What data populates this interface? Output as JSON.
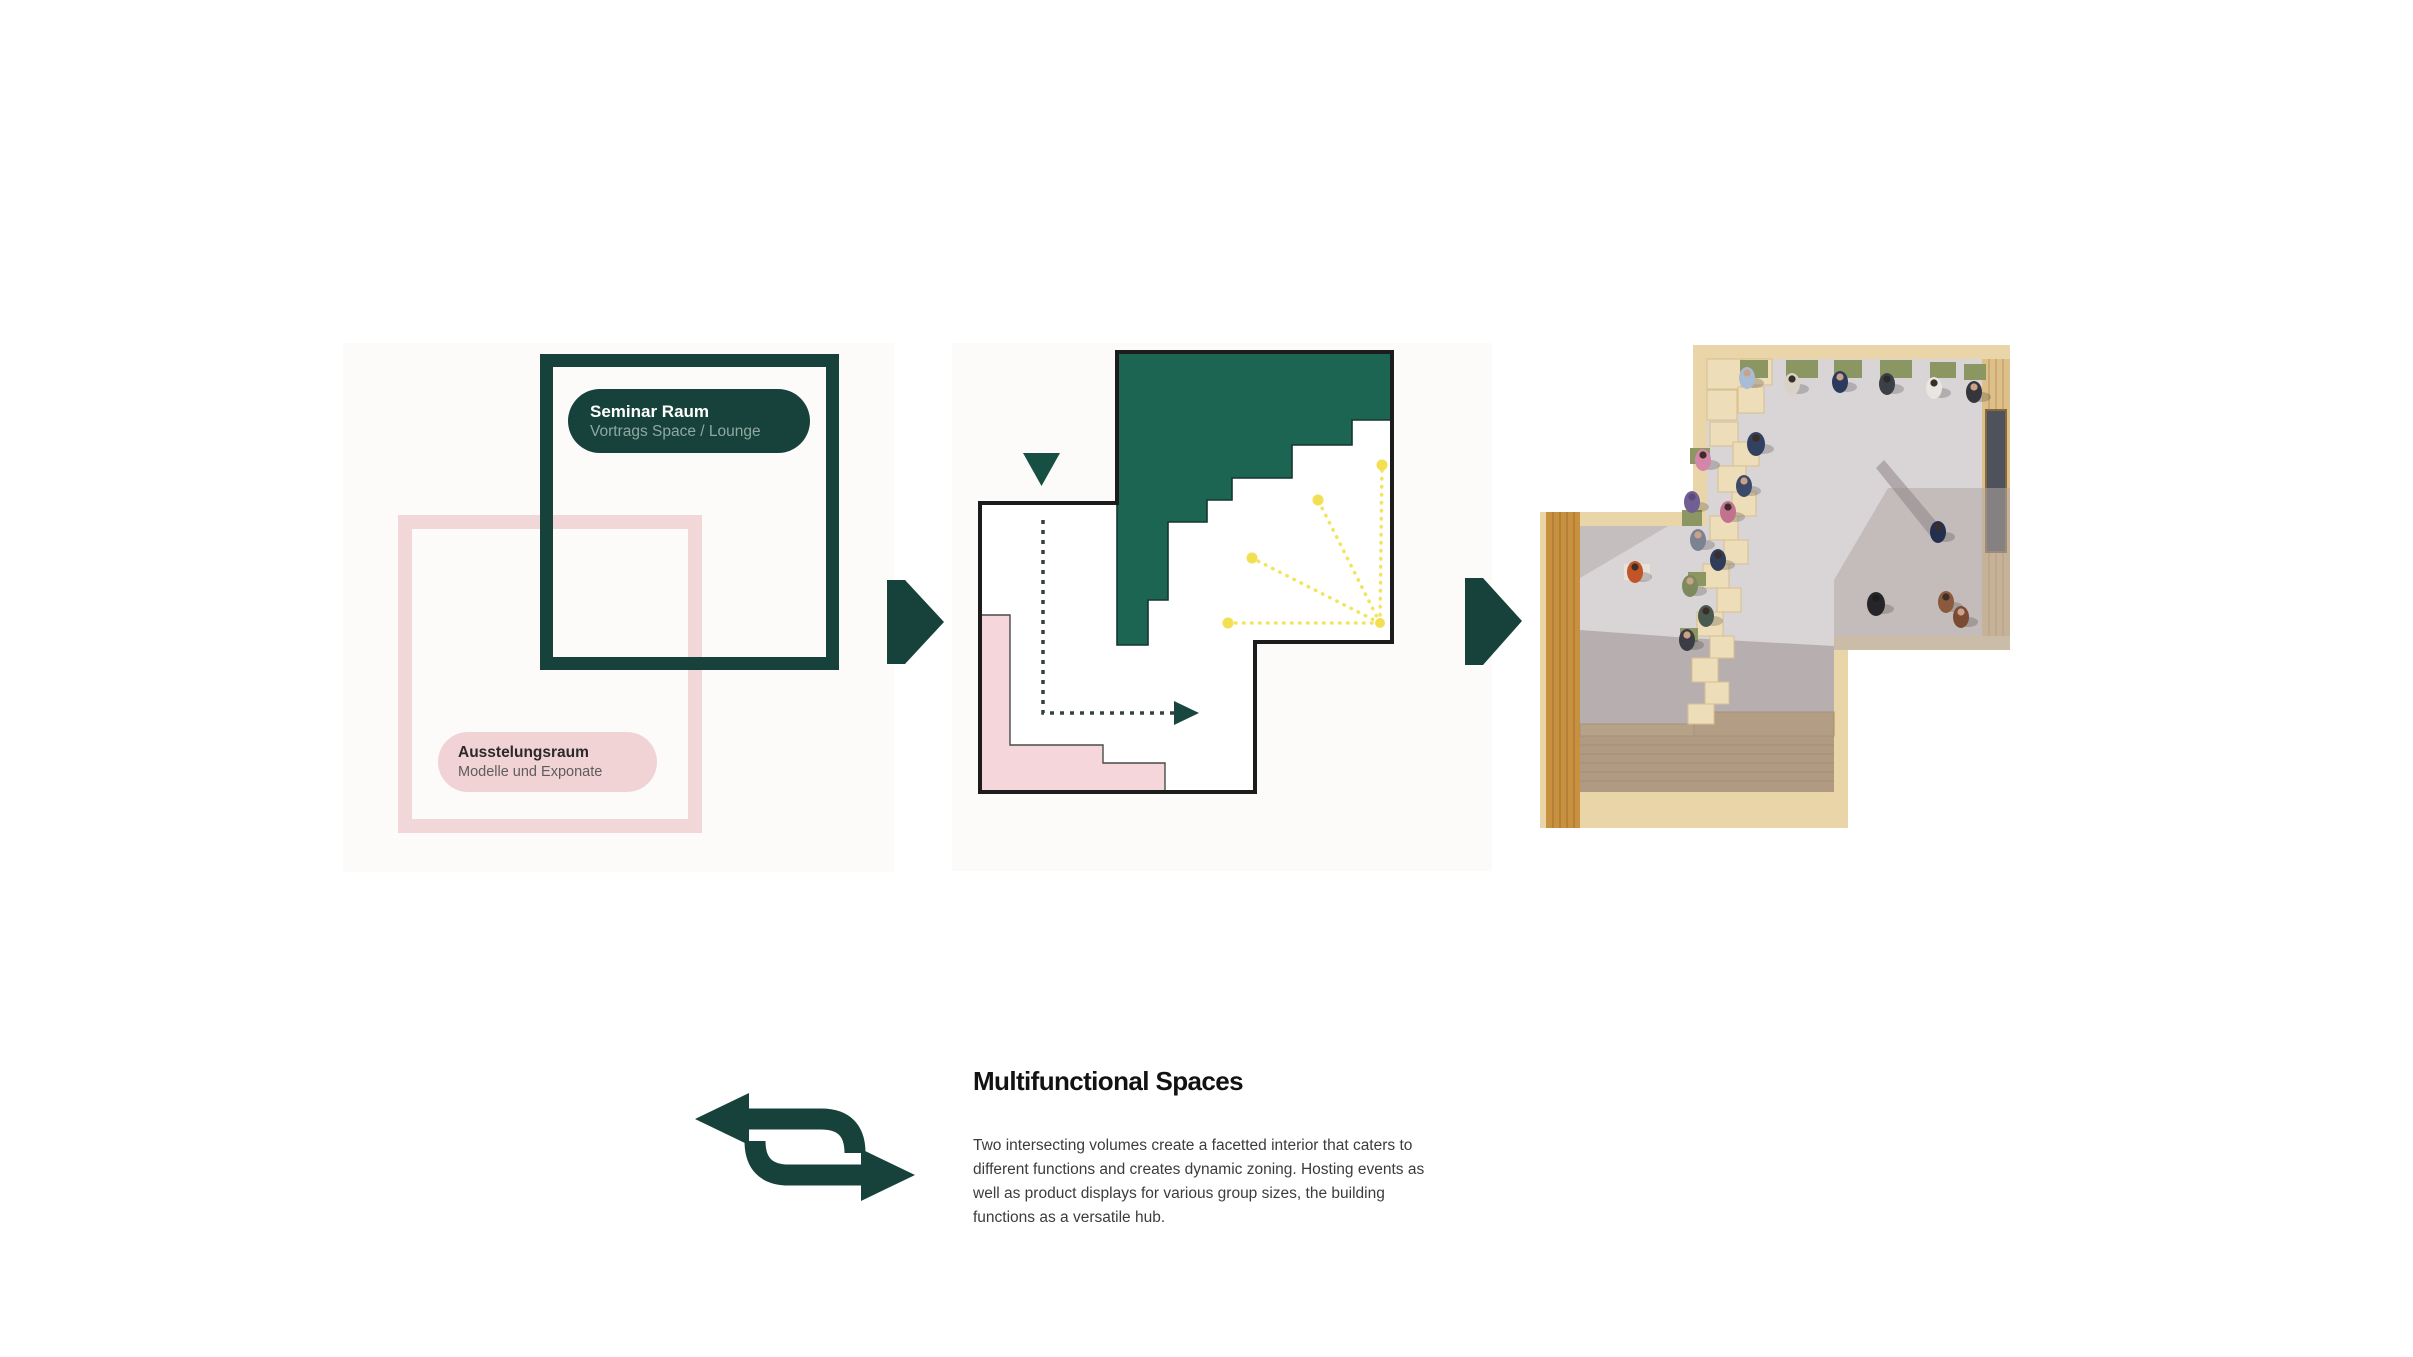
{
  "palette": {
    "dark_teal": "#17423b",
    "diagram_green_fill": "#1d6553",
    "pink_outline": "#f2d7d9",
    "pink_fill": "#f5d6da",
    "accent_yellow": "#f3e45f",
    "plan_outline_black": "#1c1c1c",
    "render_wood": "#e9d5a8",
    "render_floor_gray": "#d9d5d6"
  },
  "diagram_left": {
    "green_label": {
      "title": "Seminar Raum",
      "subtitle": "Vortrags Space / Lounge"
    },
    "pink_label": {
      "title": "Ausstelungsraum",
      "subtitle": "Modelle und Exponate"
    }
  },
  "icons": {
    "step_arrow": "arrow-right-icon",
    "entry_marker": "triangle-down-icon",
    "circulation": "dashed-flow-arrow",
    "sightlines": "yellow-dotted-fan",
    "swap": "swap-arrows-icon"
  },
  "section": {
    "title": "Multifunctional Spaces",
    "body": "Two intersecting volumes create a facetted interior that caters to different functions and creates dynamic zoning. Hosting events as well as product displays for various group sizes, the building functions as a versatile hub."
  }
}
